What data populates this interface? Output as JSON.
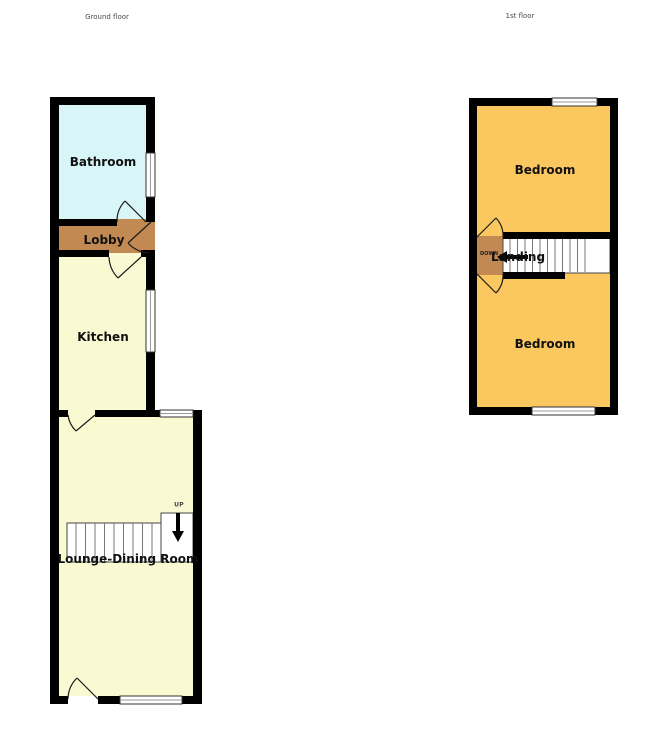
{
  "colors": {
    "wall": "#000000",
    "bathroom": "#d8f6f8",
    "lobby": "#c28a52",
    "kitchen": "#fafad2",
    "lounge": "#fafad2",
    "bedroom": "#fbc75f",
    "landing": "#c28a52",
    "stairs": "#ffffff"
  },
  "ground_floor": {
    "title": "Ground floor",
    "bathroom": "Bathroom",
    "lobby": "Lobby",
    "kitchen": "Kitchen",
    "lounge": "Lounge-Dining Room",
    "stairs_direction": "UP"
  },
  "first_floor": {
    "title": "1st floor",
    "bedroom_back": "Bedroom",
    "landing": "Landing",
    "bedroom_front": "Bedroom",
    "stairs_direction": "DOWN"
  }
}
